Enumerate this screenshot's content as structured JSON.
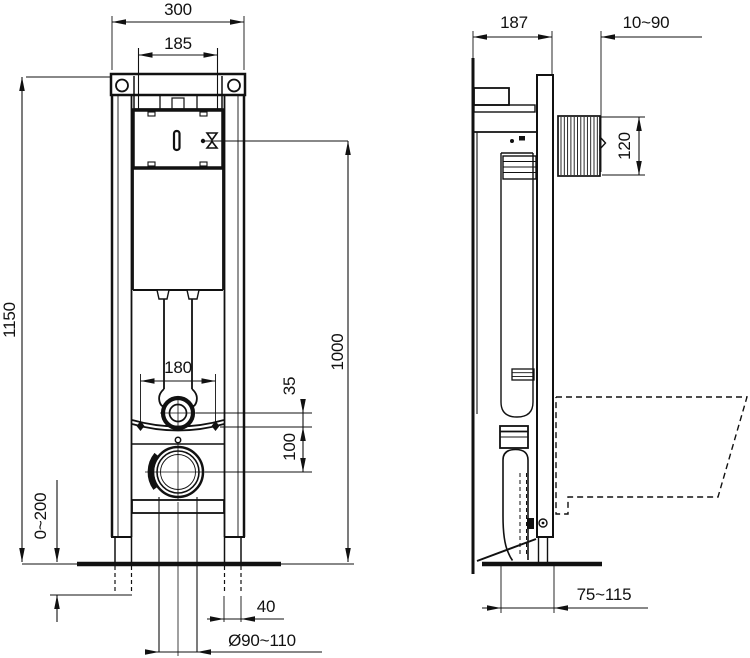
{
  "drawing": {
    "background": "#ffffff",
    "line_color": "#111111",
    "front_view": {
      "overall_width": "300",
      "hanger_width": "185",
      "frame_height": "1150",
      "flush_valve_height": "1000",
      "flush_pipe_spacing": "180",
      "flush_offset": "35",
      "outlet_offset": "100",
      "foot_adjustment": "0~200",
      "foot_tube_width": "40",
      "outlet_diameter": "Ø90~110"
    },
    "side_view": {
      "frame_depth": "187",
      "wall_clearance": "10~90",
      "sleeve_height": "120",
      "outlet_distance": "75~115"
    }
  }
}
